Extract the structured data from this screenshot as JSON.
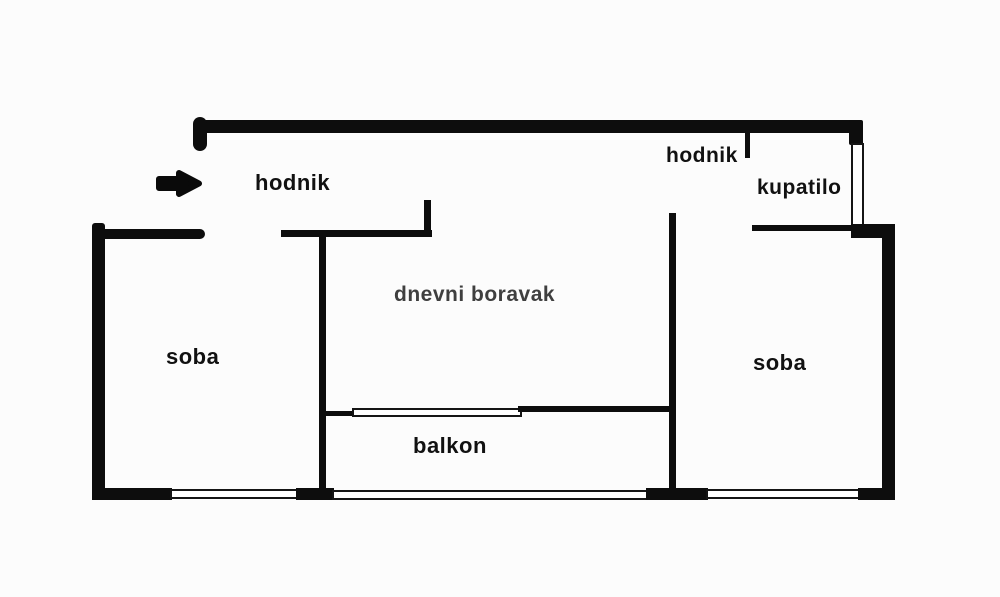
{
  "diagram": {
    "type": "apartment-floor-plan",
    "background_color": "#fcfcfc",
    "wall_color": "#0d0d0d",
    "label_color": "#111111",
    "living_room_label_color": "#3f3f3f"
  },
  "rooms": {
    "hallway_left": {
      "label": "hodnik"
    },
    "hallway_right": {
      "label": "hodnik"
    },
    "bathroom": {
      "label": "kupatilo"
    },
    "living_room": {
      "label": "dnevni boravak"
    },
    "room_left": {
      "label": "soba"
    },
    "room_right": {
      "label": "soba"
    },
    "balcony": {
      "label": "balkon"
    }
  },
  "icons": {
    "entrance_arrow": "right-arrow"
  }
}
